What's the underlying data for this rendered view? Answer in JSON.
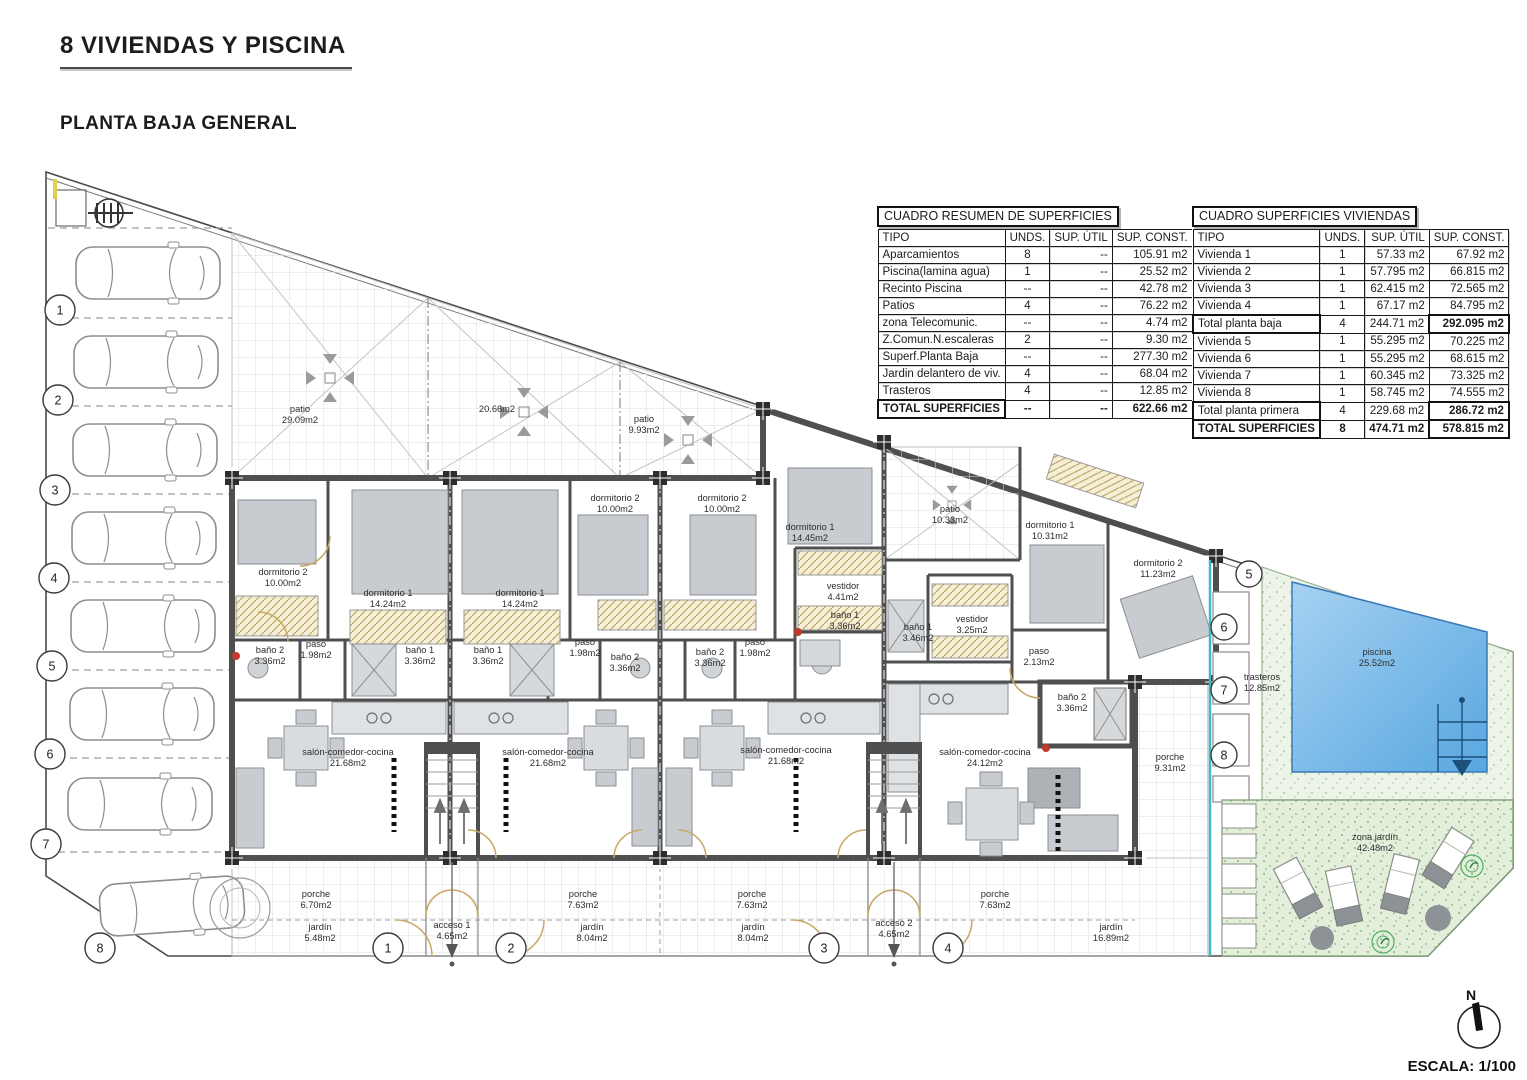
{
  "header": {
    "title": "8 VIVIENDAS Y PISCINA",
    "subtitle": "PLANTA BAJA GENERAL"
  },
  "tables": {
    "resumen": {
      "title": "CUADRO RESUMEN DE SUPERFICIES",
      "columns": [
        "TIPO",
        "UNDS.",
        "SUP. ÚTIL",
        "SUP. CONST."
      ],
      "rows": [
        [
          "Aparcamientos",
          "8",
          "--",
          "105.91 m2"
        ],
        [
          "Piscina(lamina agua)",
          "1",
          "--",
          "25.52 m2"
        ],
        [
          "Recinto Piscina",
          "--",
          "--",
          "42.78 m2"
        ],
        [
          "Patios",
          "4",
          "--",
          "76.22 m2"
        ],
        [
          "zona Telecomunic.",
          "--",
          "--",
          "4.74 m2"
        ],
        [
          "Z.Comun.N.escaleras",
          "2",
          "--",
          "9.30 m2"
        ],
        [
          "Superf.Planta Baja",
          "--",
          "--",
          "277.30 m2"
        ],
        [
          "Jardin delantero de viv.",
          "4",
          "--",
          "68.04 m2"
        ],
        [
          "Trasteros",
          "4",
          "--",
          "12.85 m2"
        ]
      ],
      "total": [
        "TOTAL SUPERFICIES",
        "--",
        "--",
        "622.66 m2"
      ]
    },
    "viviendas": {
      "title": "CUADRO SUPERFICIES VIVIENDAS",
      "columns": [
        "TIPO",
        "UNDS.",
        "SUP. ÚTIL",
        "SUP. CONST."
      ],
      "rows": [
        [
          "Vivienda 1",
          "1",
          "57.33 m2",
          "67.92 m2"
        ],
        [
          "Vivienda 2",
          "1",
          "57.795 m2",
          "66.815 m2"
        ],
        [
          "Vivienda 3",
          "1",
          "62.415 m2",
          "72.565 m2"
        ],
        [
          "Vivienda 4",
          "1",
          "67.17 m2",
          "84.795 m2"
        ],
        [
          "Total planta baja",
          "4",
          "244.71 m2",
          "292.095 m2"
        ],
        [
          "Vivienda 5",
          "1",
          "55.295 m2",
          "70.225 m2"
        ],
        [
          "Vivienda 6",
          "1",
          "55.295 m2",
          "68.615 m2"
        ],
        [
          "Vivienda 7",
          "1",
          "60.345 m2",
          "73.325 m2"
        ],
        [
          "Vivienda 8",
          "1",
          "58.745 m2",
          "74.555 m2"
        ],
        [
          "Total planta primera",
          "4",
          "229.68 m2",
          "286.72 m2"
        ]
      ],
      "total": [
        "TOTAL SUPERFICIES",
        "8",
        "474.71 m2",
        "578.815 m2"
      ]
    }
  },
  "plan": {
    "rooms": {
      "patio1": {
        "name": "patio",
        "area": "29.09m2"
      },
      "patio2": {
        "name": "",
        "area": "20.66m2"
      },
      "patio3": {
        "name": "patio",
        "area": "9.93m2"
      },
      "patio4": {
        "name": "patio",
        "area": "10.33m2"
      },
      "v1_dorm2": {
        "name": "dormitorio 2",
        "area": "10.00m2"
      },
      "v1_dorm1": {
        "name": "dormitorio 1",
        "area": "14.24m2"
      },
      "v2_dorm1": {
        "name": "dormitorio 1",
        "area": "14.24m2"
      },
      "v2_dorm2": {
        "name": "dormitorio 2",
        "area": "10.00m2"
      },
      "v3_dorm2": {
        "name": "dormitorio 2",
        "area": "10.00m2"
      },
      "v3_dorm1": {
        "name": "dormitorio 1",
        "area": "14.45m2"
      },
      "v4_dorm1": {
        "name": "dormitorio 1",
        "area": "10.31m2"
      },
      "v4_dorm2": {
        "name": "dormitorio 2",
        "area": "11.23m2"
      },
      "v1_bano2": {
        "name": "baño 2",
        "area": "3.36m2"
      },
      "v1_paso": {
        "name": "paso",
        "area": "1.98m2"
      },
      "v1_bano1": {
        "name": "baño 1",
        "area": "3.36m2"
      },
      "v2_bano1": {
        "name": "baño 1",
        "area": "3.36m2"
      },
      "v2_paso": {
        "name": "paso",
        "area": "1.98m2"
      },
      "v2_bano2": {
        "name": "baño 2",
        "area": "3.36m2"
      },
      "v3_bano2": {
        "name": "baño 2",
        "area": "3.36m2"
      },
      "v3_paso": {
        "name": "paso",
        "area": "1.98m2"
      },
      "v3_vestidor": {
        "name": "vestidor",
        "area": "4.41m2"
      },
      "v3_bano1": {
        "name": "baño 1",
        "area": "3.36m2"
      },
      "v4_bano1": {
        "name": "baño 1",
        "area": "3.46m2"
      },
      "v4_vestidor": {
        "name": "vestidor",
        "area": "3.25m2"
      },
      "v4_paso": {
        "name": "paso",
        "area": "2.13m2"
      },
      "v4_bano2": {
        "name": "baño 2",
        "area": "3.36m2"
      },
      "v1_salon": {
        "name": "salón-comedor-cocina",
        "area": "21.68m2"
      },
      "v2_salon": {
        "name": "salón-comedor-cocina",
        "area": "21.68m2"
      },
      "v3_salon": {
        "name": "salón-comedor-cocina",
        "area": "21.68m2"
      },
      "v4_salon": {
        "name": "salón-comedor-cocina",
        "area": "24.12m2"
      },
      "v1_porche": {
        "name": "porche",
        "area": "6.70m2"
      },
      "v2_porche": {
        "name": "porche",
        "area": "7.63m2"
      },
      "v3_porche": {
        "name": "porche",
        "area": "7.63m2"
      },
      "v4_porche": {
        "name": "porche",
        "area": "7.63m2"
      },
      "v4_porche2": {
        "name": "porche",
        "area": "9.31m2"
      },
      "v1_jardin": {
        "name": "jardín",
        "area": "5.48m2"
      },
      "v2_jardin": {
        "name": "jardín",
        "area": "8.04m2"
      },
      "v3_jardin": {
        "name": "jardín",
        "area": "8.04m2"
      },
      "v4_jardin": {
        "name": "jardín",
        "area": "16.89m2"
      },
      "acceso1": {
        "name": "acceso 1",
        "area": "4.65m2"
      },
      "acceso2": {
        "name": "acceso 2",
        "area": "4.65m2"
      },
      "trasteros": {
        "name": "trasteros",
        "area": "12.85m2"
      },
      "piscina": {
        "name": "piscina",
        "area": "25.52m2"
      },
      "zona_jardin": {
        "name": "zona jardín",
        "area": "42.48m2"
      }
    },
    "circles": {
      "parking": [
        "1",
        "2",
        "3",
        "4",
        "5",
        "6",
        "7",
        "8"
      ],
      "accesos": [
        "1",
        "2",
        "3",
        "4"
      ],
      "trasteros": [
        "5",
        "6",
        "7",
        "8"
      ]
    },
    "compass_label": "N",
    "scale_label": "ESCALA: 1/100"
  },
  "colors": {
    "wall": "#4f4f4f",
    "pool_light": "#a6d2f2",
    "pool_dark": "#58a7e0",
    "deck_green": "#ecf4e7",
    "garden_green": "#e3efdb",
    "hatch_fill": "#f6efd6",
    "hatch_line": "#b4a25e",
    "door_arc": "#c9a864",
    "teal_line": "#3cbcbc",
    "accent_red": "#c0392b",
    "furniture": "#c8ccd0"
  }
}
